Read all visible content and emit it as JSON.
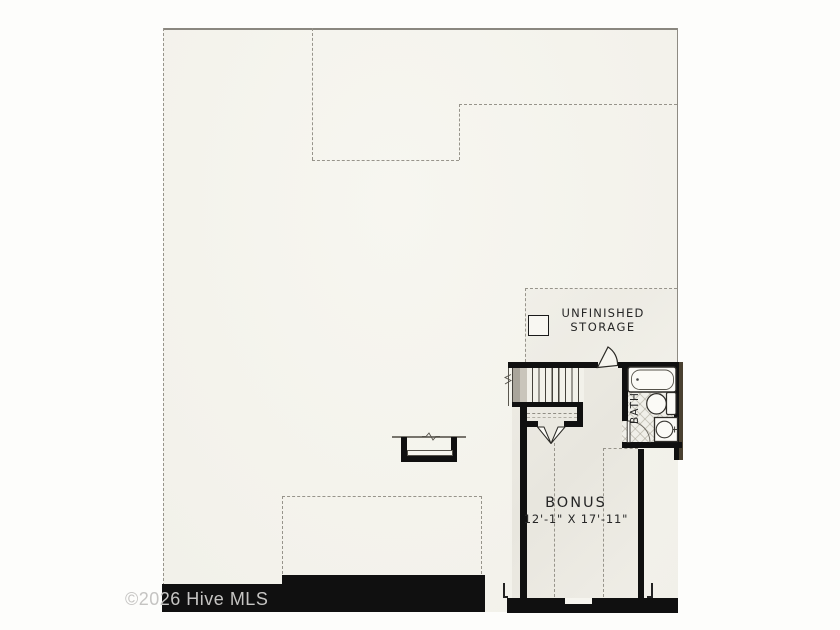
{
  "watermark": {
    "text": "©2026 Hive MLS"
  },
  "labels": {
    "storage_line1": "UNFINISHED",
    "storage_line2": "STORAGE",
    "bonus_name": "BONUS",
    "bonus_dims": "12'-1\" X 17'-11\"",
    "bath": "BATH"
  },
  "colors": {
    "wall": "#101010",
    "wall_accent": "#4a4131",
    "dashed_line": "#97948b",
    "paper": "#f4f3ec",
    "label_text": "#262626",
    "watermark_text": "#c5c4c2"
  },
  "fixtures": [
    "stairs",
    "bathtub",
    "toilet",
    "sink-vanity",
    "attic-access-panel",
    "dormer-window",
    "double-door",
    "bath-door",
    "storage-door",
    "bonus-window"
  ]
}
